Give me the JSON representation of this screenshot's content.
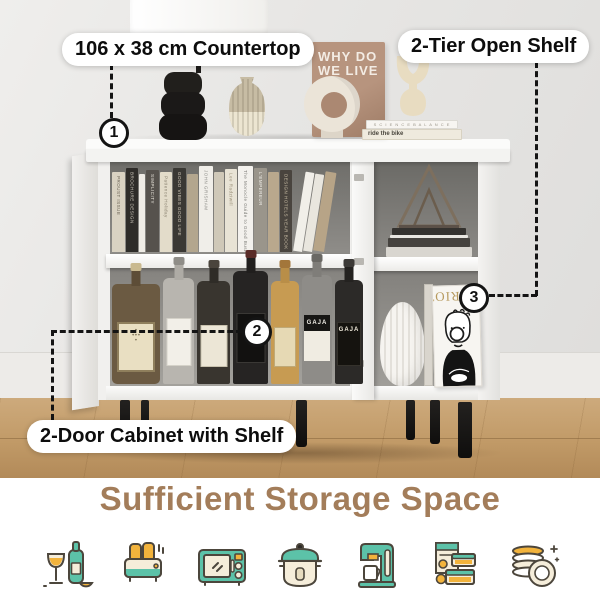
{
  "callouts": {
    "countertop": {
      "number": "1",
      "label": "106 x 38 cm Countertop"
    },
    "two_door_cabinet": {
      "number": "2",
      "label": "2-Door Cabinet with Shelf"
    },
    "open_shelf": {
      "number": "3",
      "label": "2-Tier Open Shelf"
    }
  },
  "headline": {
    "text": "Sufficient Storage Space",
    "color": "#a37d5a"
  },
  "scene": {
    "poster": {
      "line1": "WHY DO",
      "line2": "WE LIVE"
    },
    "stacked_books": {
      "top": "S C I E N C E  B A L A N C E",
      "bottom": "ride the bike"
    },
    "display_book": {
      "title": "LORIOT"
    },
    "wine_labels": {
      "gaja_1": "GAJA",
      "gaja_2": "GAJA"
    },
    "shelf_books": [
      {
        "title": "PROUST ISSUE"
      },
      {
        "title": "BROCHURE DESIGN"
      },
      {
        "title": ""
      },
      {
        "title": "SIMPLICITY"
      },
      {
        "title": "Patience Holiday"
      },
      {
        "title": "GOOD VIBES GOOD LIFE"
      },
      {
        "title": ""
      },
      {
        "title": "JOHN GRISHAM"
      },
      {
        "title": ""
      },
      {
        "title": "Lee Radziwill"
      },
      {
        "title": "The Monocle Guide to Good Business"
      },
      {
        "title": "L'EMPEREUR"
      },
      {
        "title": ""
      },
      {
        "title": "DESIGN HOTELS YEAR BOOK"
      }
    ]
  },
  "footer_icons": [
    {
      "name": "drinks"
    },
    {
      "name": "toaster"
    },
    {
      "name": "microwave"
    },
    {
      "name": "cooking-pot"
    },
    {
      "name": "coffee-machine"
    },
    {
      "name": "food-containers"
    },
    {
      "name": "plates"
    }
  ],
  "colors": {
    "accent_teal": "#5cc2a8",
    "accent_yellow": "#f2b33c",
    "accent_cream": "#f5edda",
    "outline": "#4c463c",
    "title_brown": "#a37d5a",
    "callout_line": "#141414"
  }
}
